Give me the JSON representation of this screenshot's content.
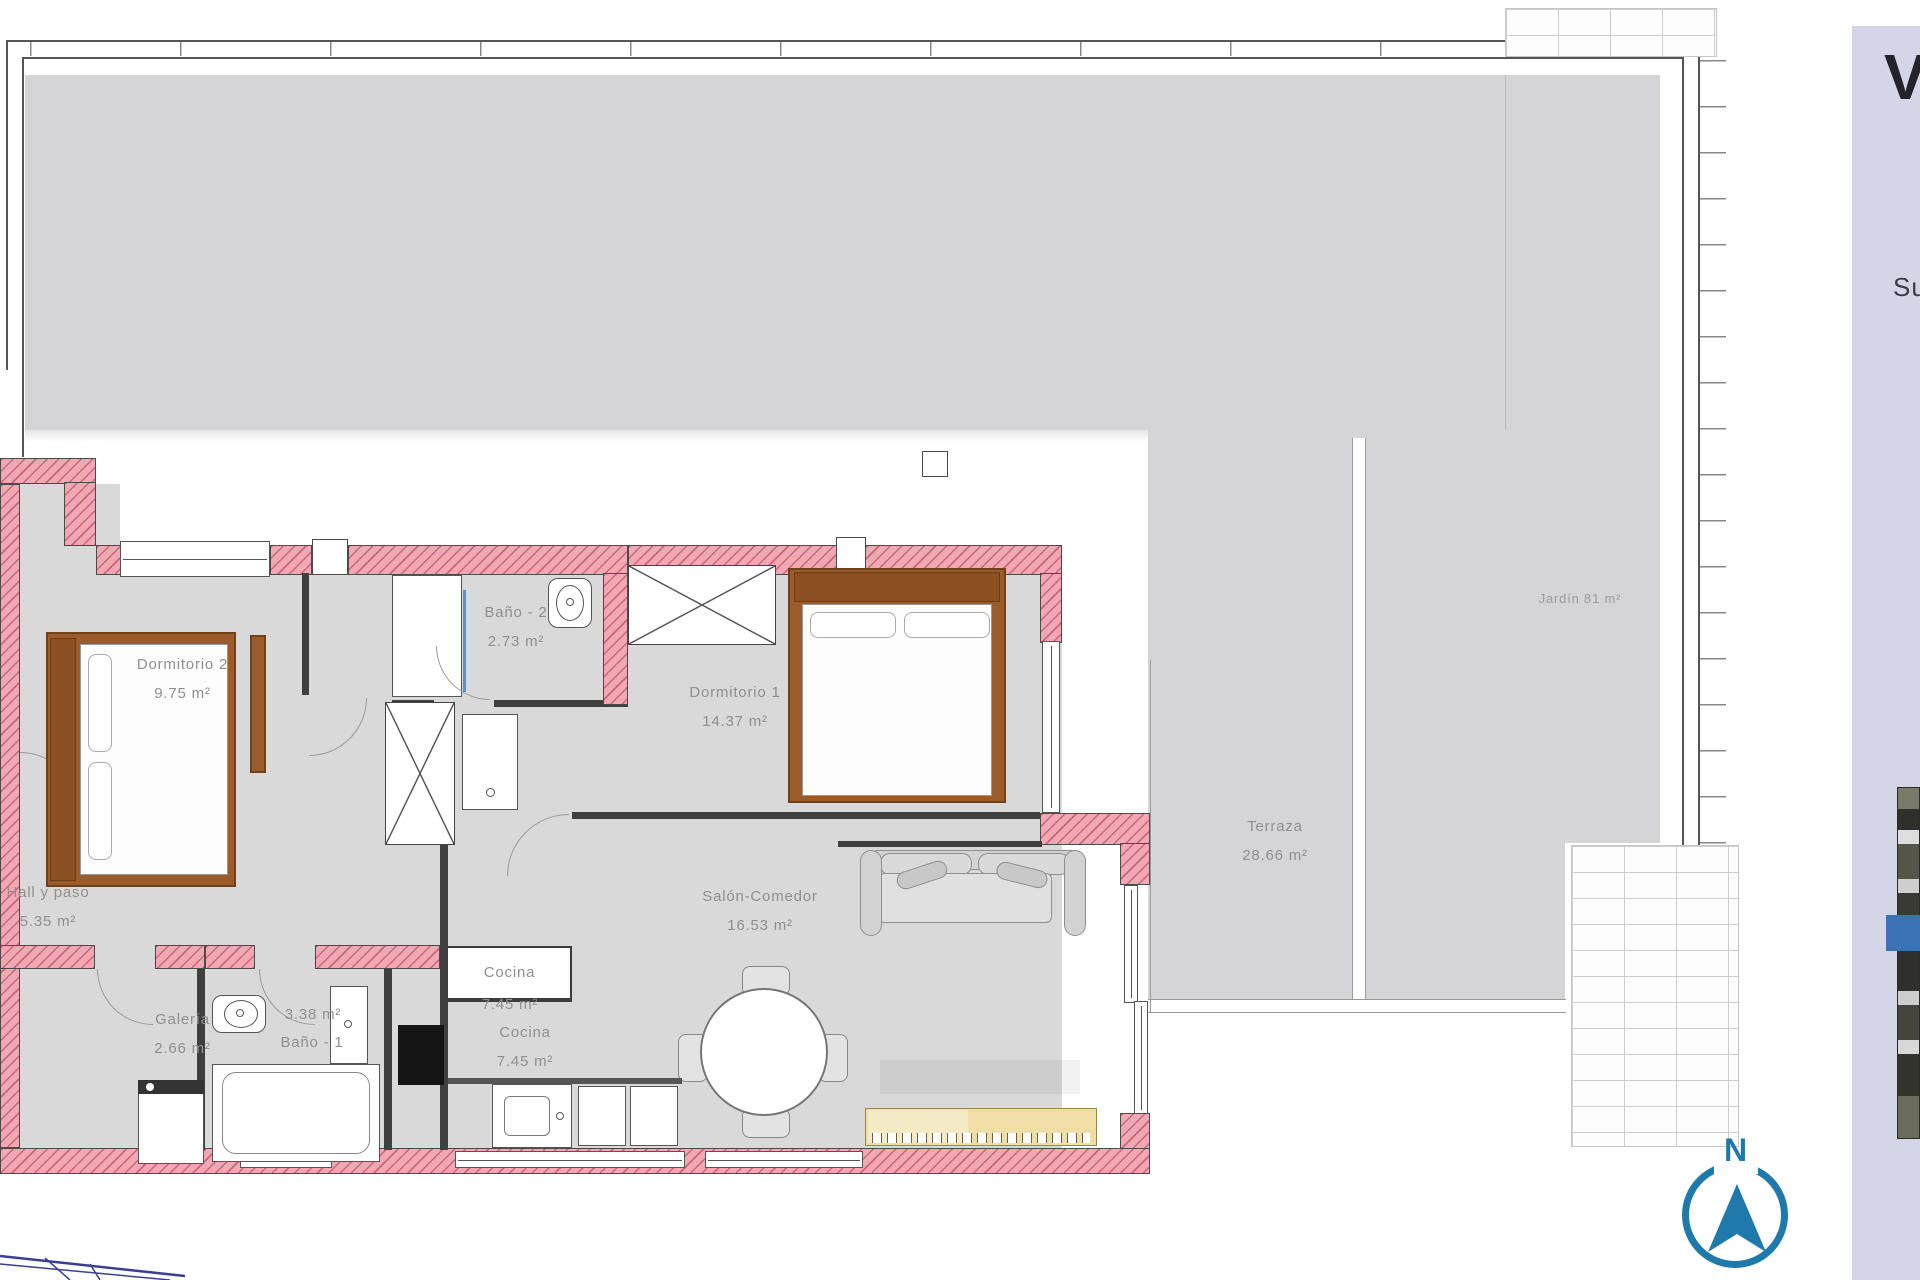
{
  "panel": {
    "title": "V",
    "subtitle": "Su"
  },
  "compass": {
    "north_label": "N"
  },
  "rooms": [
    {
      "id": "dormitorio2",
      "name": "Dormitorio 2",
      "area": "9.75 m²"
    },
    {
      "id": "bano2",
      "name": "Baño - 2",
      "area": "2.73 m²"
    },
    {
      "id": "dormitorio1",
      "name": "Dormitorio 1",
      "area": "14.37 m²"
    },
    {
      "id": "terraza",
      "name": "Terraza",
      "area": "28.66 m²"
    },
    {
      "id": "salon",
      "name": "Salón-Comedor",
      "area": "16.53 m²"
    },
    {
      "id": "cocina_counter",
      "name": "Cocina",
      "area": "7.45 m²"
    },
    {
      "id": "cocina",
      "name": "Cocina",
      "area": "7.45 m²"
    },
    {
      "id": "galeria",
      "name": "Galería",
      "area": "2.66 m²"
    },
    {
      "id": "bano1",
      "area": "3.38 m²",
      "name": "Baño - 1"
    },
    {
      "id": "hall",
      "name": "Hall y paso",
      "area": "5.35 m²"
    },
    {
      "id": "jardin",
      "name": "Jardín 81 m²"
    }
  ],
  "colors": {
    "wall_pink": "#f2a8b4",
    "floor_gray": "#d9d9d9",
    "outdoor_gray": "#d5d5d7",
    "accent_blue": "#1f7aab",
    "sidebar_lavender": "#d4d6e8",
    "sideboard_tan": "#efdfa6"
  }
}
